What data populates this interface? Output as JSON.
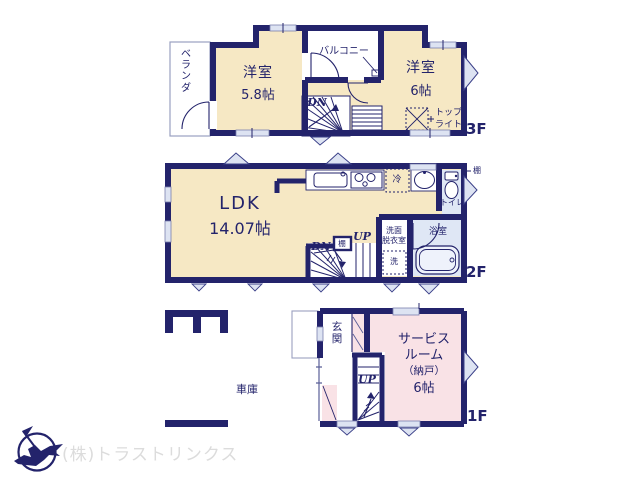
{
  "colors": {
    "wall_navy": "#23236b",
    "room_cream": "#f6e8c4",
    "room_pink": "#f9e2e6",
    "wet_area_blue": "#dfe7f5",
    "window_blue": "#dde3f2",
    "logo_gray": "#dcdcdc"
  },
  "floor3": {
    "floor_label": "3F",
    "veranda_label": "ベランダ",
    "balcony_label": "バルコニー",
    "bedroom_small_name": "洋室",
    "bedroom_small_size": "5.8帖",
    "bedroom_large_name": "洋室",
    "bedroom_large_size": "6帖",
    "stairs_down_label": "DN",
    "skylight_label_line1": "トップ",
    "skylight_label_line2": "ライト"
  },
  "floor2": {
    "floor_label": "2F",
    "ldk_name": "LDK",
    "ldk_size": "14.07帖",
    "fridge_label": "冷",
    "wall_shelf_label": "棚",
    "toilet_label": "トイレ",
    "washroom_label_line1": "洗面",
    "washroom_label_line2": "脱衣室",
    "washer_label": "洗",
    "bathroom_label": "浴室",
    "stairs_down_label": "DN",
    "stairs_up_label": "UP",
    "stair_shelf_label": "棚"
  },
  "floor1": {
    "floor_label": "1F",
    "garage_label": "車庫",
    "entrance_label": "玄関",
    "stairs_up_label": "UP",
    "service_room_line1": "サービス",
    "service_room_line2": "ルーム",
    "service_room_line3": "（納戸）",
    "service_room_size": "6帖"
  },
  "footer": {
    "company_name": "(株)トラストリンクス"
  }
}
